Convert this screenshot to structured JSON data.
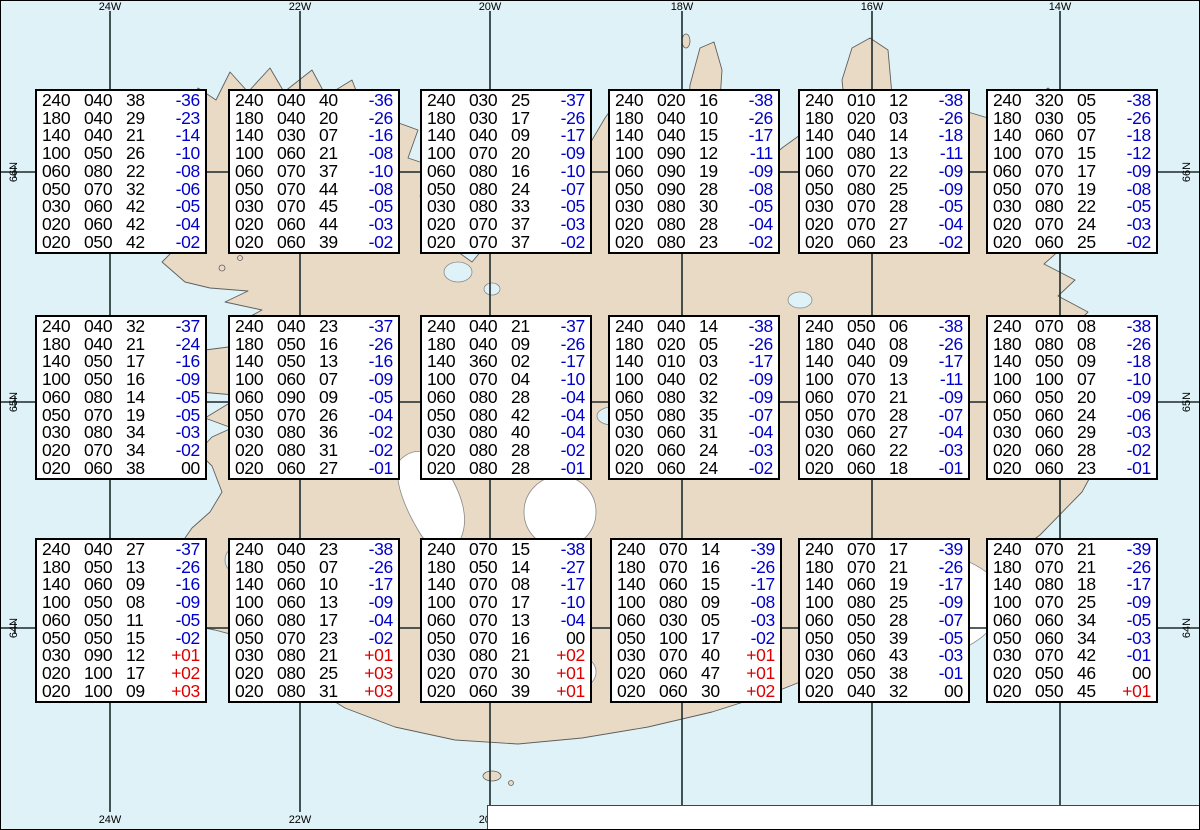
{
  "colors": {
    "water": "#dff2f8",
    "land": "#e9dac5",
    "glacier": "#ffffff",
    "grid": "#1c2b2b",
    "temp_neg": "#0000cc",
    "temp_pos": "#dd0000"
  },
  "grid": {
    "meridians": [
      {
        "label": "24W",
        "x": 110
      },
      {
        "label": "22W",
        "x": 300
      },
      {
        "label": "20W",
        "x": 490
      },
      {
        "label": "18W",
        "x": 682
      },
      {
        "label": "16W",
        "x": 872
      },
      {
        "label": "14W",
        "x": 1060
      }
    ],
    "parallels": [
      {
        "label": "66N",
        "y": 172
      },
      {
        "label": "65N",
        "y": 402
      },
      {
        "label": "64N",
        "y": 628
      }
    ],
    "minor_tick_xs": [
      15,
      205,
      395,
      586,
      777,
      966,
      1155
    ]
  },
  "column_meaning": "FL Dir KT °C",
  "boxes": [
    {
      "x": 35,
      "y": 89,
      "rows": [
        [
          "240",
          "040",
          "38",
          "-36"
        ],
        [
          "180",
          "040",
          "29",
          "-23"
        ],
        [
          "140",
          "040",
          "21",
          "-14"
        ],
        [
          "100",
          "050",
          "26",
          "-10"
        ],
        [
          "060",
          "080",
          "22",
          "-08"
        ],
        [
          "050",
          "070",
          "32",
          "-06"
        ],
        [
          "030",
          "060",
          "42",
          "-05"
        ],
        [
          "020",
          "060",
          "42",
          "-04"
        ],
        [
          "020",
          "050",
          "42",
          "-02"
        ]
      ]
    },
    {
      "x": 228,
      "y": 89,
      "rows": [
        [
          "240",
          "040",
          "40",
          "-36"
        ],
        [
          "180",
          "040",
          "20",
          "-26"
        ],
        [
          "140",
          "030",
          "07",
          "-16"
        ],
        [
          "100",
          "060",
          "21",
          "-08"
        ],
        [
          "060",
          "070",
          "37",
          "-10"
        ],
        [
          "050",
          "070",
          "44",
          "-08"
        ],
        [
          "030",
          "070",
          "45",
          "-05"
        ],
        [
          "020",
          "060",
          "44",
          "-03"
        ],
        [
          "020",
          "060",
          "39",
          "-02"
        ]
      ]
    },
    {
      "x": 420,
      "y": 89,
      "rows": [
        [
          "240",
          "030",
          "25",
          "-37"
        ],
        [
          "180",
          "030",
          "17",
          "-26"
        ],
        [
          "140",
          "040",
          "09",
          "-17"
        ],
        [
          "100",
          "070",
          "20",
          "-09"
        ],
        [
          "060",
          "080",
          "16",
          "-10"
        ],
        [
          "050",
          "080",
          "24",
          "-07"
        ],
        [
          "030",
          "080",
          "33",
          "-05"
        ],
        [
          "020",
          "070",
          "37",
          "-03"
        ],
        [
          "020",
          "070",
          "37",
          "-02"
        ]
      ]
    },
    {
      "x": 608,
      "y": 89,
      "rows": [
        [
          "240",
          "020",
          "16",
          "-38"
        ],
        [
          "180",
          "040",
          "10",
          "-26"
        ],
        [
          "140",
          "040",
          "15",
          "-17"
        ],
        [
          "100",
          "090",
          "12",
          "-11"
        ],
        [
          "060",
          "090",
          "19",
          "-09"
        ],
        [
          "050",
          "090",
          "28",
          "-08"
        ],
        [
          "030",
          "080",
          "30",
          "-05"
        ],
        [
          "020",
          "080",
          "28",
          "-04"
        ],
        [
          "020",
          "080",
          "23",
          "-02"
        ]
      ]
    },
    {
      "x": 798,
      "y": 89,
      "rows": [
        [
          "240",
          "010",
          "12",
          "-38"
        ],
        [
          "180",
          "020",
          "03",
          "-26"
        ],
        [
          "140",
          "040",
          "14",
          "-18"
        ],
        [
          "100",
          "080",
          "13",
          "-11"
        ],
        [
          "060",
          "070",
          "22",
          "-09"
        ],
        [
          "050",
          "080",
          "25",
          "-09"
        ],
        [
          "030",
          "070",
          "28",
          "-05"
        ],
        [
          "020",
          "070",
          "27",
          "-04"
        ],
        [
          "020",
          "060",
          "23",
          "-02"
        ]
      ]
    },
    {
      "x": 986,
      "y": 89,
      "rows": [
        [
          "240",
          "320",
          "05",
          "-38"
        ],
        [
          "180",
          "030",
          "05",
          "-26"
        ],
        [
          "140",
          "060",
          "07",
          "-18"
        ],
        [
          "100",
          "070",
          "15",
          "-12"
        ],
        [
          "060",
          "070",
          "17",
          "-09"
        ],
        [
          "050",
          "070",
          "19",
          "-08"
        ],
        [
          "030",
          "080",
          "22",
          "-05"
        ],
        [
          "020",
          "070",
          "24",
          "-03"
        ],
        [
          "020",
          "060",
          "25",
          "-02"
        ]
      ]
    },
    {
      "x": 35,
      "y": 315,
      "rows": [
        [
          "240",
          "040",
          "32",
          "-37"
        ],
        [
          "180",
          "040",
          "21",
          "-24"
        ],
        [
          "140",
          "050",
          "17",
          "-16"
        ],
        [
          "100",
          "050",
          "16",
          "-09"
        ],
        [
          "060",
          "080",
          "14",
          "-05"
        ],
        [
          "050",
          "070",
          "19",
          "-05"
        ],
        [
          "030",
          "080",
          "34",
          "-03"
        ],
        [
          "020",
          "070",
          "34",
          "-02"
        ],
        [
          "020",
          "060",
          "38",
          "00"
        ]
      ]
    },
    {
      "x": 228,
      "y": 315,
      "rows": [
        [
          "240",
          "040",
          "23",
          "-37"
        ],
        [
          "180",
          "050",
          "16",
          "-26"
        ],
        [
          "140",
          "050",
          "13",
          "-16"
        ],
        [
          "100",
          "060",
          "07",
          "-09"
        ],
        [
          "060",
          "090",
          "09",
          "-05"
        ],
        [
          "050",
          "070",
          "26",
          "-04"
        ],
        [
          "030",
          "080",
          "36",
          "-02"
        ],
        [
          "020",
          "080",
          "31",
          "-02"
        ],
        [
          "020",
          "060",
          "27",
          "-01"
        ]
      ]
    },
    {
      "x": 420,
      "y": 315,
      "rows": [
        [
          "240",
          "040",
          "21",
          "-37"
        ],
        [
          "180",
          "040",
          "09",
          "-26"
        ],
        [
          "140",
          "360",
          "02",
          "-17"
        ],
        [
          "100",
          "070",
          "04",
          "-10"
        ],
        [
          "060",
          "080",
          "28",
          "-04"
        ],
        [
          "050",
          "080",
          "42",
          "-04"
        ],
        [
          "030",
          "080",
          "40",
          "-04"
        ],
        [
          "020",
          "080",
          "28",
          "-02"
        ],
        [
          "020",
          "080",
          "28",
          "-01"
        ]
      ]
    },
    {
      "x": 608,
      "y": 315,
      "rows": [
        [
          "240",
          "040",
          "14",
          "-38"
        ],
        [
          "180",
          "020",
          "05",
          "-26"
        ],
        [
          "140",
          "010",
          "03",
          "-17"
        ],
        [
          "100",
          "040",
          "02",
          "-09"
        ],
        [
          "060",
          "080",
          "32",
          "-09"
        ],
        [
          "050",
          "080",
          "35",
          "-07"
        ],
        [
          "030",
          "060",
          "31",
          "-04"
        ],
        [
          "020",
          "060",
          "24",
          "-03"
        ],
        [
          "020",
          "060",
          "24",
          "-02"
        ]
      ]
    },
    {
      "x": 798,
      "y": 315,
      "rows": [
        [
          "240",
          "050",
          "06",
          "-38"
        ],
        [
          "180",
          "040",
          "08",
          "-26"
        ],
        [
          "140",
          "040",
          "09",
          "-17"
        ],
        [
          "100",
          "070",
          "13",
          "-11"
        ],
        [
          "060",
          "070",
          "21",
          "-09"
        ],
        [
          "050",
          "070",
          "28",
          "-07"
        ],
        [
          "030",
          "060",
          "27",
          "-04"
        ],
        [
          "020",
          "060",
          "22",
          "-03"
        ],
        [
          "020",
          "060",
          "18",
          "-01"
        ]
      ]
    },
    {
      "x": 986,
      "y": 315,
      "rows": [
        [
          "240",
          "070",
          "08",
          "-38"
        ],
        [
          "180",
          "080",
          "08",
          "-26"
        ],
        [
          "140",
          "050",
          "09",
          "-18"
        ],
        [
          "100",
          "100",
          "07",
          "-10"
        ],
        [
          "060",
          "050",
          "20",
          "-09"
        ],
        [
          "050",
          "060",
          "24",
          "-06"
        ],
        [
          "030",
          "060",
          "29",
          "-03"
        ],
        [
          "020",
          "060",
          "28",
          "-02"
        ],
        [
          "020",
          "060",
          "23",
          "-01"
        ]
      ]
    },
    {
      "x": 35,
      "y": 538,
      "rows": [
        [
          "240",
          "040",
          "27",
          "-37"
        ],
        [
          "180",
          "050",
          "13",
          "-26"
        ],
        [
          "140",
          "060",
          "09",
          "-16"
        ],
        [
          "100",
          "050",
          "08",
          "-09"
        ],
        [
          "060",
          "050",
          "11",
          "-05"
        ],
        [
          "050",
          "050",
          "15",
          "-02"
        ],
        [
          "030",
          "090",
          "12",
          "+01"
        ],
        [
          "020",
          "100",
          "17",
          "+02"
        ],
        [
          "020",
          "100",
          "09",
          "+03"
        ]
      ]
    },
    {
      "x": 228,
      "y": 538,
      "rows": [
        [
          "240",
          "040",
          "23",
          "-38"
        ],
        [
          "180",
          "050",
          "07",
          "-26"
        ],
        [
          "140",
          "060",
          "10",
          "-17"
        ],
        [
          "100",
          "060",
          "13",
          "-09"
        ],
        [
          "060",
          "080",
          "17",
          "-04"
        ],
        [
          "050",
          "070",
          "23",
          "-02"
        ],
        [
          "030",
          "080",
          "21",
          "+01"
        ],
        [
          "020",
          "080",
          "25",
          "+03"
        ],
        [
          "020",
          "080",
          "31",
          "+03"
        ]
      ]
    },
    {
      "x": 420,
      "y": 538,
      "rows": [
        [
          "240",
          "070",
          "15",
          "-38"
        ],
        [
          "180",
          "050",
          "14",
          "-27"
        ],
        [
          "140",
          "070",
          "08",
          "-17"
        ],
        [
          "100",
          "070",
          "17",
          "-10"
        ],
        [
          "060",
          "070",
          "13",
          "-04"
        ],
        [
          "050",
          "070",
          "16",
          "00"
        ],
        [
          "030",
          "080",
          "21",
          "+02"
        ],
        [
          "020",
          "070",
          "30",
          "+01"
        ],
        [
          "020",
          "060",
          "39",
          "+01"
        ]
      ]
    },
    {
      "x": 610,
      "y": 538,
      "rows": [
        [
          "240",
          "070",
          "14",
          "-39"
        ],
        [
          "180",
          "070",
          "16",
          "-26"
        ],
        [
          "140",
          "060",
          "15",
          "-17"
        ],
        [
          "100",
          "080",
          "09",
          "-08"
        ],
        [
          "060",
          "030",
          "05",
          "-03"
        ],
        [
          "050",
          "100",
          "17",
          "-02"
        ],
        [
          "030",
          "070",
          "40",
          "+01"
        ],
        [
          "020",
          "060",
          "47",
          "+01"
        ],
        [
          "020",
          "060",
          "30",
          "+02"
        ]
      ]
    },
    {
      "x": 798,
      "y": 538,
      "rows": [
        [
          "240",
          "070",
          "17",
          "-39"
        ],
        [
          "180",
          "070",
          "21",
          "-26"
        ],
        [
          "140",
          "060",
          "19",
          "-17"
        ],
        [
          "100",
          "080",
          "25",
          "-09"
        ],
        [
          "060",
          "050",
          "28",
          "-07"
        ],
        [
          "050",
          "050",
          "39",
          "-05"
        ],
        [
          "030",
          "060",
          "43",
          "-03"
        ],
        [
          "020",
          "050",
          "38",
          "-01"
        ],
        [
          "020",
          "040",
          "32",
          "00"
        ]
      ]
    },
    {
      "x": 986,
      "y": 538,
      "rows": [
        [
          "240",
          "070",
          "21",
          "-39"
        ],
        [
          "180",
          "070",
          "21",
          "-26"
        ],
        [
          "140",
          "080",
          "18",
          "-17"
        ],
        [
          "100",
          "070",
          "25",
          "-09"
        ],
        [
          "060",
          "060",
          "34",
          "-05"
        ],
        [
          "050",
          "060",
          "34",
          "-03"
        ],
        [
          "030",
          "070",
          "42",
          "-01"
        ],
        [
          "020",
          "050",
          "46",
          "00"
        ],
        [
          "020",
          "050",
          "45",
          "+01"
        ]
      ]
    }
  ],
  "caption": {
    "prefix": "Spot Chart: FL Dir KT °C ",
    "product": "UWC/IG-IS:",
    "issue": " IT: Sun. 09. Nóv. 2025 18Z ",
    "valid": "VT: Mán. 10.11.2025 12Z",
    "suffix": " (+18 h)"
  }
}
